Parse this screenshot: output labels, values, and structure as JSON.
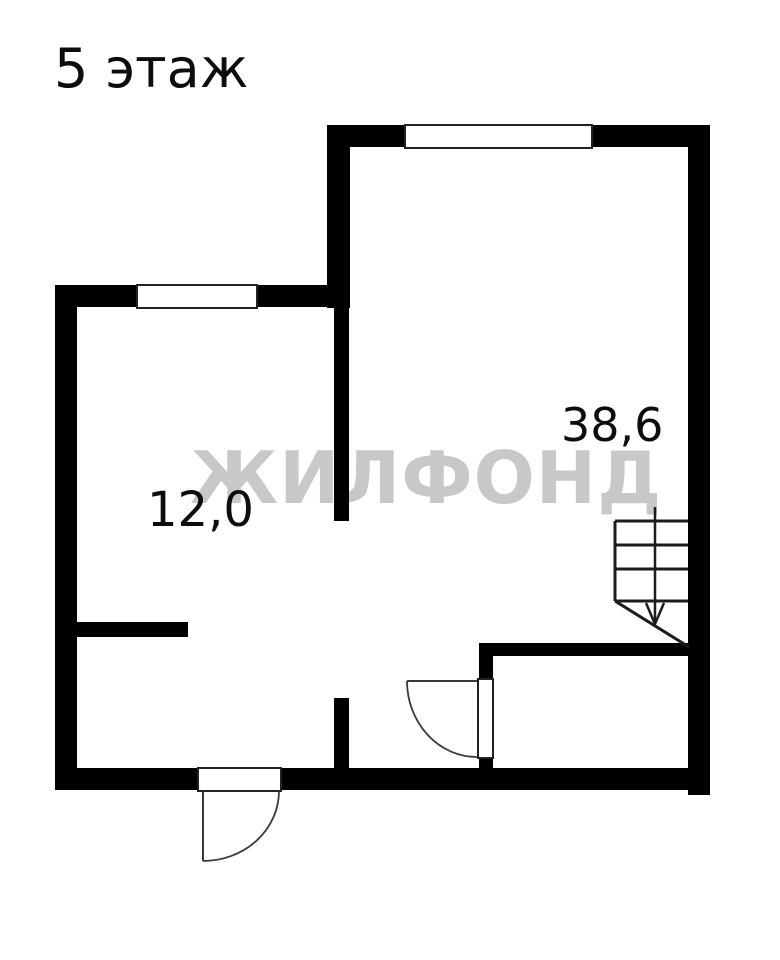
{
  "title": "5 этаж",
  "watermark": "ЖИЛФОНД",
  "rooms": {
    "small": {
      "area": "12,0"
    },
    "large": {
      "area": "38,6"
    }
  },
  "colors": {
    "background": "#ffffff",
    "wall": "#000000",
    "watermark": "#c8c8c8",
    "line": "#222222"
  },
  "symbols": {
    "stairs": "stairs-with-down-arrow",
    "entry_door": "door-swing-arc",
    "bathroom_door": "door-swing-arc"
  }
}
